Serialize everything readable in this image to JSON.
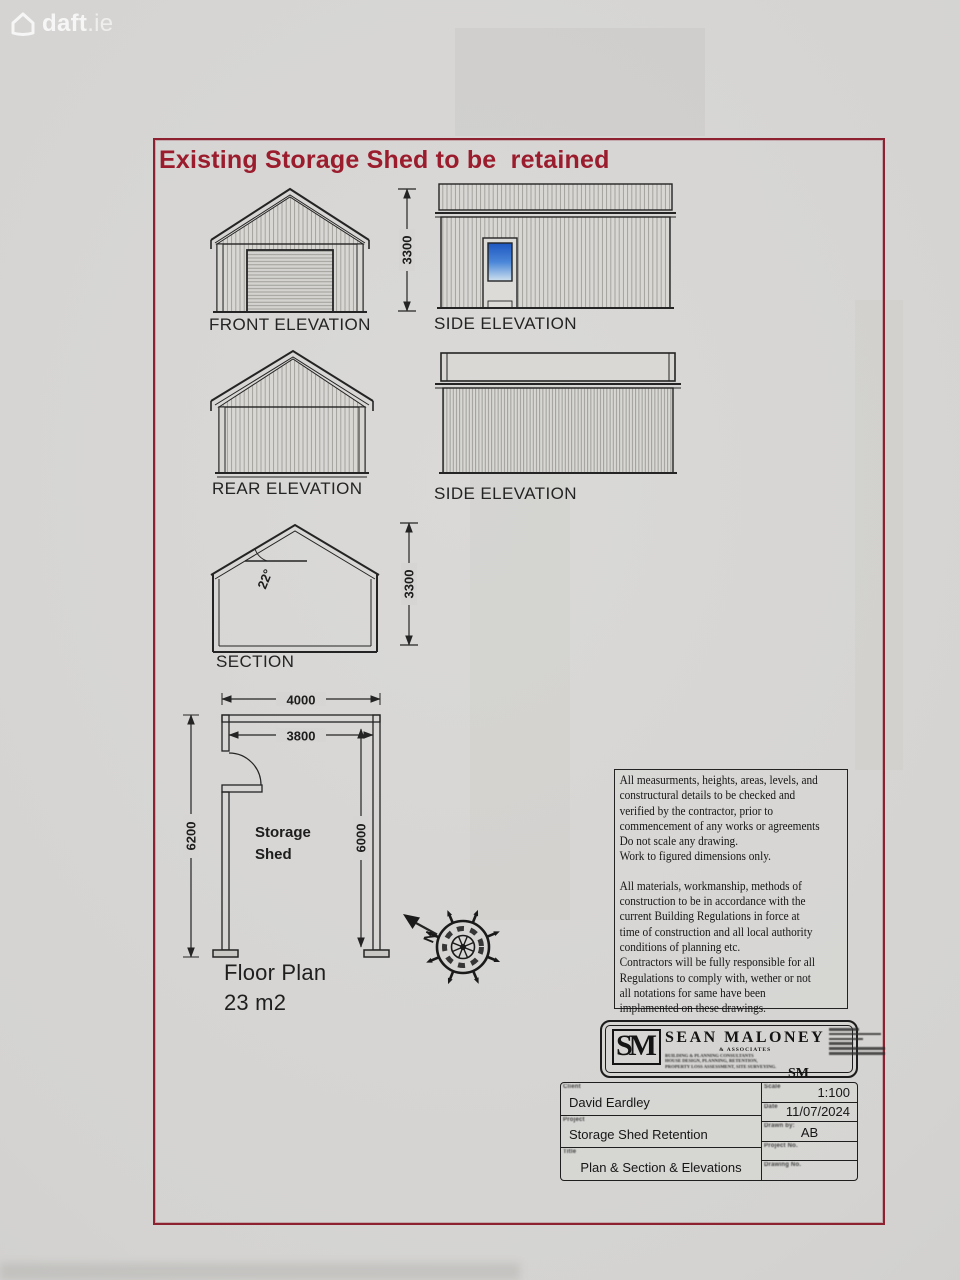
{
  "watermark": {
    "brand_bold": "daft",
    "brand_tld": ".ie"
  },
  "sheet": {
    "title": "Existing Storage Shed to be  retained"
  },
  "labels": {
    "front_elevation": "FRONT ELEVATION",
    "side_elevation_1": "SIDE ELEVATION",
    "rear_elevation": "REAR ELEVATION",
    "side_elevation_2": "SIDE ELEVATION",
    "section": "SECTION",
    "floor_plan": "Floor Plan",
    "floor_plan_area": "23 m2",
    "room_line1": "Storage",
    "room_line2": "Shed",
    "north": "N"
  },
  "dimensions": {
    "elevation_height": "3300",
    "section_height": "3300",
    "roof_pitch": "22°",
    "plan_overall_width": "4000",
    "plan_internal_width": "3800",
    "plan_overall_depth": "6200",
    "plan_internal_depth": "6000"
  },
  "notes": {
    "block1": "All measurments, heights, areas, levels, and\nconstructural details to be checked and\nverified by the contractor, prior to\ncommencement of any works or agreements\nDo not scale any drawing.\nWork to figured dimensions only.",
    "block2": "All materials, workmanship, methods of\nconstruction to be in accordance with the\ncurrent Building Regulations in force at\ntime of construction and all local authority\nconditions of planning etc.\nContractors will be fully responsible for all\nRegulations to comply with, wether or not\nall notations for same have been\nimplamented on these drawings."
  },
  "company": {
    "initials": "SM",
    "name": "SEAN MALONEY",
    "subtitle": "& ASSOCIATES",
    "services": "BUILDING & PLANNING CONSULTANTS\nHOUSE DESIGN, PLANNING, RETENTION,\nPROPERTY LOSS ASSESSMENT, SITE SURVEYING.",
    "stamp": "SM"
  },
  "title_block": {
    "client_label": "Client",
    "client": "David Eardley",
    "project_label": "Project",
    "project": "Storage Shed Retention",
    "title_label": "Title",
    "drawing_title": "Plan & Section & Elevations",
    "scale_label": "Scale",
    "scale": "1:100",
    "date_label": "Date",
    "date": "11/07/2024",
    "drawn_by_label": "Drawn by:",
    "drawn_by": "AB",
    "project_no_label": "Project No.",
    "project_no": "",
    "drawing_no_label": "Drawing No.",
    "drawing_no": ""
  },
  "colors": {
    "accent_red": "#9b1c2d",
    "border_red": "#8e2130",
    "line": "#242424",
    "paper": "#d6d5d3",
    "window_blue_top": "#1f57c0",
    "window_blue_bottom": "#cfe0ee"
  }
}
